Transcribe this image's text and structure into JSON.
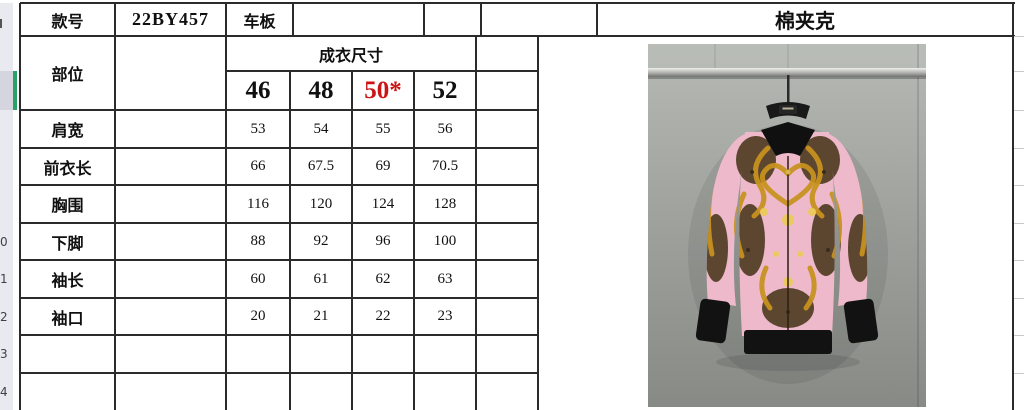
{
  "header": {
    "style_no_label": "款号",
    "style_no_value": "22BY457",
    "board_label": "车板",
    "product_name": "棉夹克"
  },
  "size_table": {
    "part_label": "部位",
    "section_title": "成衣尺寸",
    "sizes": [
      "46",
      "48",
      "50*",
      "52"
    ],
    "highlighted_size": "50*",
    "highlighted_size_index": 2,
    "rows": [
      {
        "label": "肩宽",
        "values": [
          "53",
          "54",
          "55",
          "56"
        ]
      },
      {
        "label": "前衣长",
        "values": [
          "66",
          "67.5",
          "69",
          "70.5"
        ]
      },
      {
        "label": "胸围",
        "values": [
          "116",
          "120",
          "124",
          "128"
        ]
      },
      {
        "label": "下脚",
        "values": [
          "88",
          "92",
          "96",
          "100"
        ]
      },
      {
        "label": "袖长",
        "values": [
          "60",
          "61",
          "62",
          "63"
        ]
      },
      {
        "label": "袖口",
        "values": [
          "20",
          "21",
          "22",
          "23"
        ]
      }
    ],
    "empty_row_count": 2
  },
  "row_header_strip": {
    "visible_partial_numbers": [
      "0",
      "1",
      "2",
      "3",
      "4"
    ]
  },
  "colors": {
    "size_highlight_red": "#cc1414",
    "selection_green": "#27a567",
    "grid_border": "#2b2b2b",
    "row_header_bg": "#e9e9f0",
    "row_header_selected_bg": "#d5d5df",
    "light_gridline": "#c9c9c9",
    "photo_wall_gray": "#a3a6a1",
    "jacket_pink": "#edb9cb",
    "jacket_gold": "#c8921f",
    "jacket_brown": "#5c4630",
    "jacket_black": "#141414"
  }
}
